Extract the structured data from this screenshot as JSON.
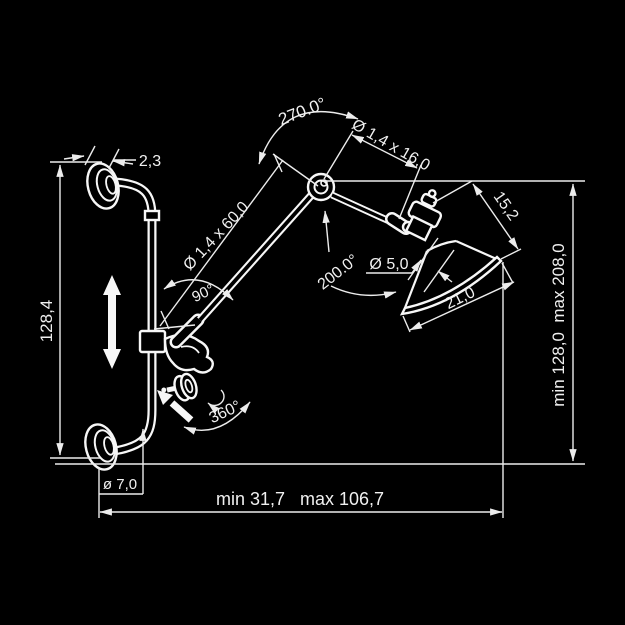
{
  "colors": {
    "background": "#000000",
    "line": "#f2f2f2",
    "text": "#f0f0f0"
  },
  "labels": {
    "plate_thickness": "2,3",
    "bar_length": "128,4",
    "plate_diameter": "ø 7,0",
    "reach_horizontal": "min 31,7   max 106,7",
    "reach_vertical": "min 128,0  max 208,0",
    "elbow_swing": "270.0°",
    "arm_rod": "Ø 1,4 x 60,0",
    "arm_angle": "90°",
    "forearm_rod": "Ø 1,4 x 16,0",
    "head_swing": "200.0°",
    "socket_diameter": "Ø 5,0",
    "shade_depth": "15,2",
    "shade_diameter": "21,0",
    "bar_swivel": "360°"
  }
}
